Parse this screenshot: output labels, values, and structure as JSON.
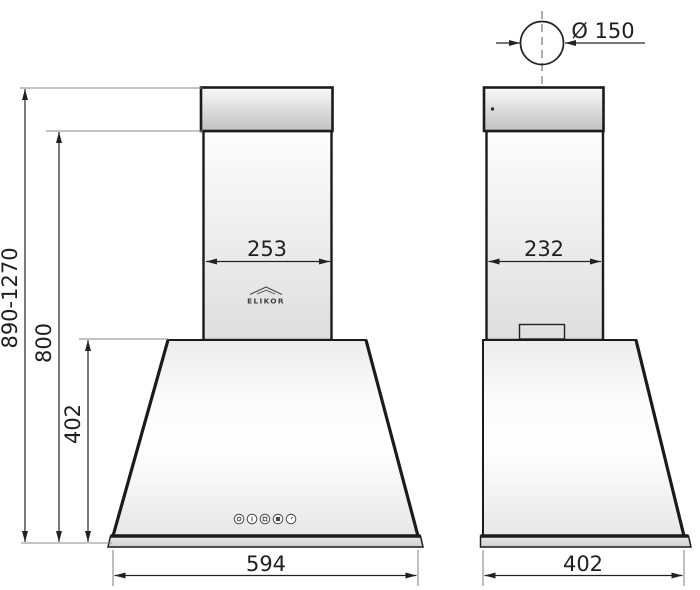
{
  "drawing": {
    "brand": "ELIKOR",
    "dimensions": {
      "front_chimney_width": "253",
      "front_body_width": "594",
      "total_height_range": "890-1270",
      "height_to_chimney_top": "800",
      "canopy_height": "402",
      "side_chimney_depth": "232",
      "side_body_depth": "402",
      "duct_diameter": "Ø 150"
    },
    "controls": {
      "buttons": [
        "light",
        "speed-1",
        "speed-2",
        "speed-3",
        "timer"
      ]
    },
    "colors": {
      "outline": "#1b1b1b",
      "dimension_line": "#222222",
      "extension_line": "#8a8a8a",
      "centerline": "#6a6a6a",
      "metal_light": "#f8f8f8",
      "metal_dark": "#c1c1c1"
    }
  }
}
